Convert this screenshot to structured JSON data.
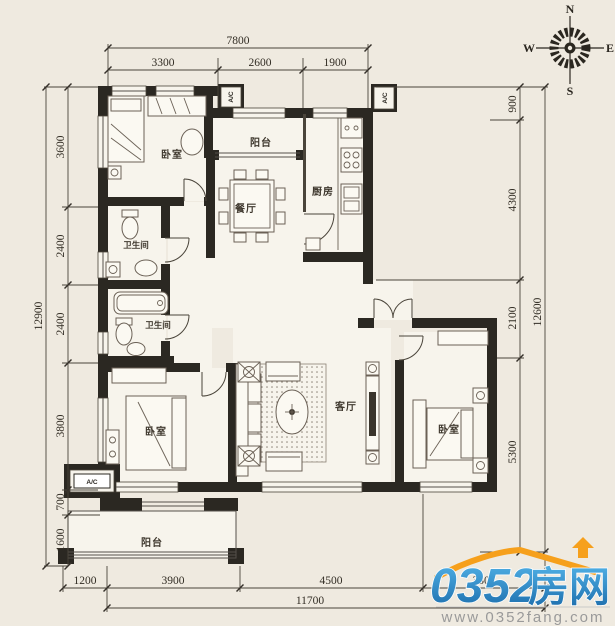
{
  "colors": {
    "background": "#efeae0",
    "wall": "#2b2822",
    "line": "#4a443a",
    "room_fill": "#f7f4ec",
    "logo_blue_light": "#52b3e8",
    "logo_blue_dark": "#1a6aa9",
    "logo_orange": "#f6a01c",
    "logo_gray": "#9a9a9a"
  },
  "compass": {
    "n": "N",
    "e": "E",
    "s": "S",
    "w": "W"
  },
  "rooms": {
    "bedroom_top_left": "卧室",
    "balcony_top": "阳台",
    "kitchen": "厨房",
    "dining_room": "餐厅",
    "bathroom_upper": "卫生间",
    "bathroom_lower": "卫生间",
    "living_room": "客厅",
    "bedroom_bottom_left": "卧室",
    "bedroom_bottom_right": "卧室",
    "balcony_bottom": "阳台",
    "ac_unit": "A/C"
  },
  "dimensions": {
    "top": {
      "total": "7800",
      "segments": [
        "3300",
        "2600",
        "1900"
      ]
    },
    "left": {
      "total": "12900",
      "segments": [
        "3600",
        "2400",
        "2400",
        "3800",
        "700",
        "1600"
      ]
    },
    "right": {
      "total": "12600",
      "segments": [
        "900",
        "4300",
        "2100",
        "5300"
      ]
    },
    "bottom": {
      "total": "11700",
      "segments": [
        "1200",
        "3900",
        "4500",
        "3300"
      ]
    }
  },
  "watermark": {
    "brand_number": "0352",
    "brand_name": "房网",
    "url": "www.0352fang.com"
  }
}
